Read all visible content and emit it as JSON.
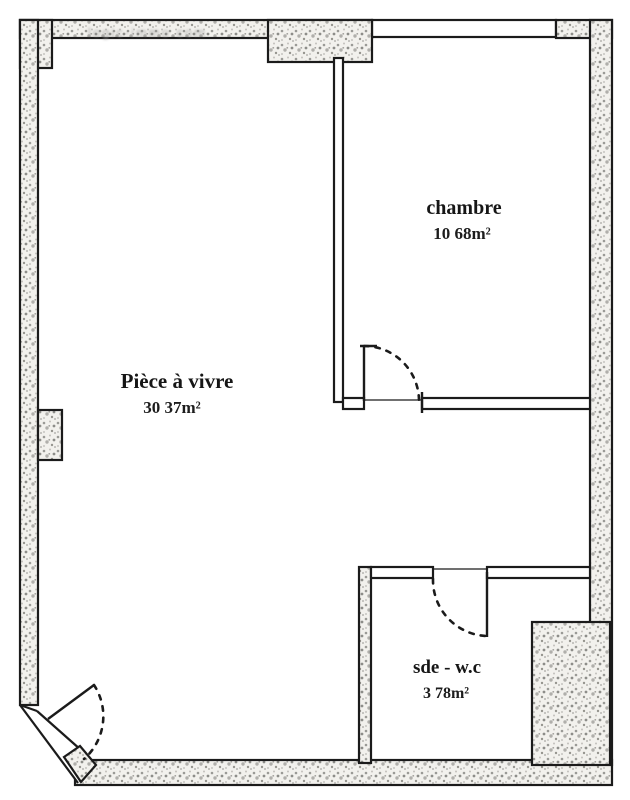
{
  "floorplan": {
    "title": "apartment-floor-plan",
    "watermark": "logic-immo com",
    "rooms": [
      {
        "id": "piece-a-vivre",
        "name": "Pièce à vivre",
        "area": "30 37m²"
      },
      {
        "id": "chambre",
        "name": "chambre",
        "area": "10 68m²"
      },
      {
        "id": "sde-wc",
        "name": "sde - w.c",
        "area": "3 78m²"
      }
    ],
    "colors": {
      "line": "#1b1b1b",
      "wall_fill": "#f2f1ed",
      "speckle_dark": "#8d8d89",
      "speckle_light": "#c2c1bd",
      "background": "#ffffff",
      "watermark_gray": "#9b9b9b"
    }
  }
}
